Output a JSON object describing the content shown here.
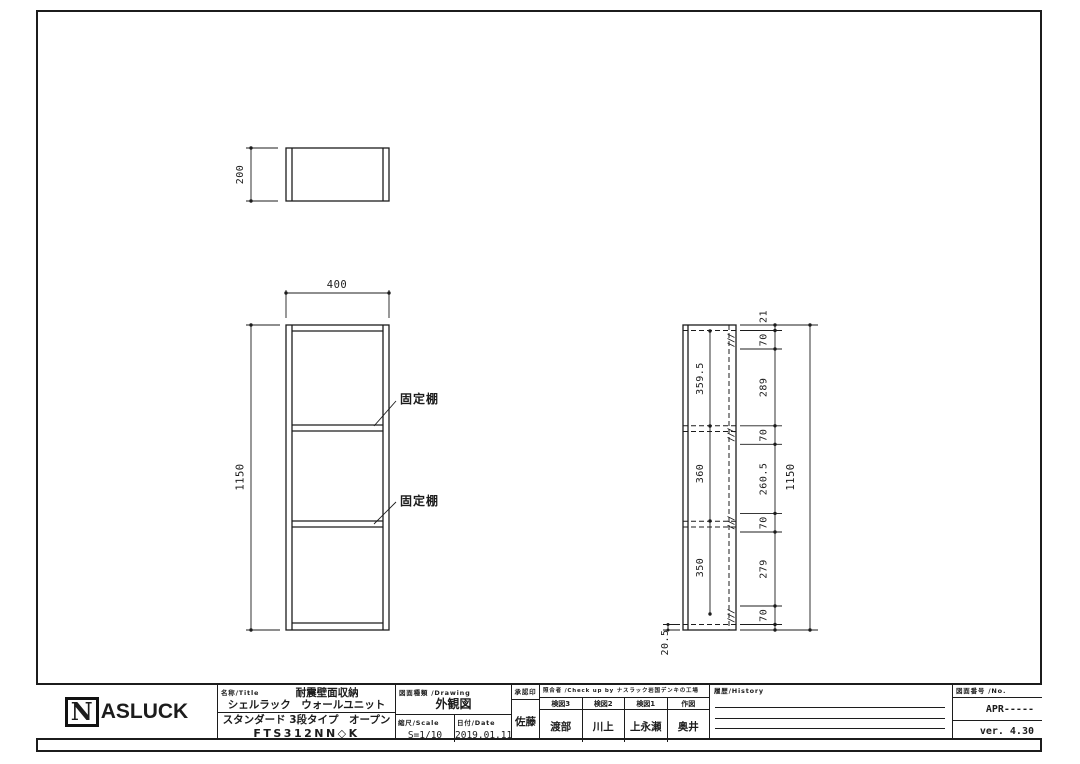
{
  "sheet": {
    "logo": {
      "initial": "N",
      "rest": "ASLUCK"
    },
    "views": {
      "top": {
        "height_dim": "200"
      },
      "front": {
        "width_dim": "400",
        "height_dim": "1150",
        "shelf_label": "固定棚"
      },
      "side": {
        "inner_dims": [
          "359.5",
          "360",
          "350"
        ],
        "right_chain": [
          "21",
          "70",
          "289",
          "70",
          "260.5",
          "70",
          "279",
          "70"
        ],
        "bottom_left_dim": "20.5",
        "overall_dim": "1150"
      }
    },
    "title_block": {
      "name_label": "名称/Title",
      "title_line1": "耐震壁面収納",
      "title_line2": "シェルラック　ウォールユニット",
      "title_line3": "スタンダード 3段タイプ　オープン",
      "model": "FTS312NN◇K",
      "drawing_label": "図面種類 /Drawing",
      "drawing_value": "外観図",
      "scale_label": "縮尺/Scale",
      "scale_value": "S=1/10",
      "date_label": "日付/Date",
      "date_value": "2019.01.11",
      "approval_label": "承認印",
      "approval_name": "佐藤",
      "check_label": "照合者 /Check up by ナスラック岩国デンキの工場",
      "check_columns": [
        {
          "role": "検図3",
          "name": "渡部"
        },
        {
          "role": "検図2",
          "name": "川上"
        },
        {
          "role": "検図1",
          "name": "上永瀬"
        },
        {
          "role": "作図",
          "name": "奥井"
        }
      ],
      "history_label": "履歴/History",
      "no_label": "図面番号 /No.",
      "drawing_no": "APR-----",
      "version": "ver. 4.30"
    }
  }
}
